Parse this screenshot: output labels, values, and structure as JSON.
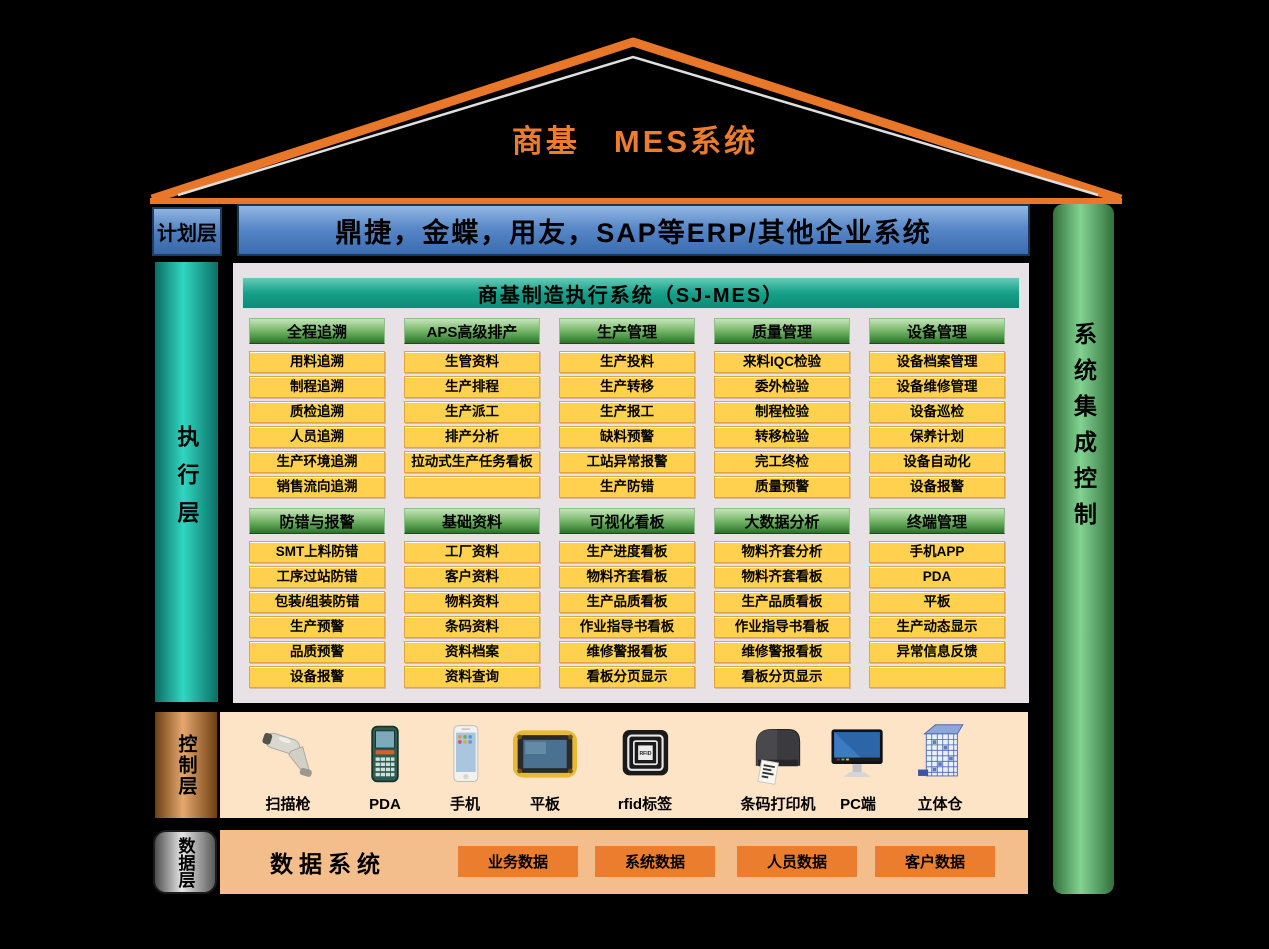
{
  "diagram_title": "商基　MES系统",
  "layers": {
    "planning": {
      "label": "计划层",
      "erp_systems": "鼎捷，金蝶，用友，SAP等ERP/其他企业系统"
    },
    "execution": {
      "label": "执行层",
      "system_header": "商基制造执行系统（SJ-MES）",
      "module_groups_row1": [
        {
          "title": "全程追溯",
          "items": [
            "用料追溯",
            "制程追溯",
            "质检追溯",
            "人员追溯",
            "生产环境追溯",
            "销售流向追溯"
          ]
        },
        {
          "title": "APS高级排产",
          "items": [
            "生管资料",
            "生产排程",
            "生产派工",
            "排产分析",
            "拉动式生产任务看板",
            ""
          ]
        },
        {
          "title": "生产管理",
          "items": [
            "生产投料",
            "生产转移",
            "生产报工",
            "缺料预警",
            "工站异常报警",
            "生产防错"
          ]
        },
        {
          "title": "质量管理",
          "items": [
            "来料IQC检验",
            "委外检验",
            "制程检验",
            "转移检验",
            "完工终检",
            "质量预警"
          ]
        },
        {
          "title": "设备管理",
          "items": [
            "设备档案管理",
            "设备维修管理",
            "设备巡检",
            "保养计划",
            "设备自动化",
            "设备报警"
          ]
        }
      ],
      "module_groups_row2": [
        {
          "title": "防错与报警",
          "items": [
            "SMT上料防错",
            "工序过站防错",
            "包装/组装防错",
            "生产预警",
            "品质预警",
            "设备报警"
          ]
        },
        {
          "title": "基础资料",
          "items": [
            "工厂资料",
            "客户资料",
            "物料资料",
            "条码资料",
            "资料档案",
            "资料查询"
          ]
        },
        {
          "title": "可视化看板",
          "items": [
            "生产进度看板",
            "物料齐套看板",
            "生产品质看板",
            "作业指导书看板",
            "维修警报看板",
            "看板分页显示"
          ]
        },
        {
          "title": "大数据分析",
          "items": [
            "物料齐套分析",
            "物料齐套看板",
            "生产品质看板",
            "作业指导书看板",
            "维修警报看板",
            "看板分页显示"
          ]
        },
        {
          "title": "终端管理",
          "items": [
            "手机APP",
            "PDA",
            "平板",
            "生产动态显示",
            "异常信息反馈",
            ""
          ]
        }
      ]
    },
    "control": {
      "label": "控制层",
      "devices": [
        {
          "name": "扫描枪",
          "icon": "barcode-scanner-icon"
        },
        {
          "name": "PDA",
          "icon": "pda-icon"
        },
        {
          "name": "手机",
          "icon": "smartphone-icon"
        },
        {
          "name": "平板",
          "icon": "tablet-icon"
        },
        {
          "name": "rfid标签",
          "icon": "rfid-tag-icon",
          "chip_text": "RFID"
        },
        {
          "name": "条码打印机",
          "icon": "barcode-printer-icon"
        },
        {
          "name": "PC端",
          "icon": "pc-icon"
        },
        {
          "name": "立体仓",
          "icon": "warehouse-icon"
        }
      ]
    },
    "data": {
      "label": "数据层",
      "title": "数据系统",
      "databases": [
        "业务数据",
        "系统数据",
        "人员数据",
        "客户数据"
      ]
    }
  },
  "integration_bar": {
    "label": "系统集成控制"
  },
  "colors": {
    "roof_orange": "#E8772A",
    "title_orange": "#ED7D2E",
    "erp_blue": "#4A7CBE",
    "teal_header": "#17A089",
    "exec_teal": "#31D6C2",
    "module_header_green": "#7CBB6E",
    "module_item_yellow": "#FFD14E",
    "module_item_border": "#E2A53E",
    "panel_gray": "#E8E2E6",
    "integration_green": "#82D392",
    "control_copper": "#E5A76F",
    "data_silver": "#E6E6E6",
    "control_strip_peach": "#FDE4C6",
    "data_strip_orange": "#F4BE8C",
    "db_button_orange": "#EB7D2E"
  }
}
